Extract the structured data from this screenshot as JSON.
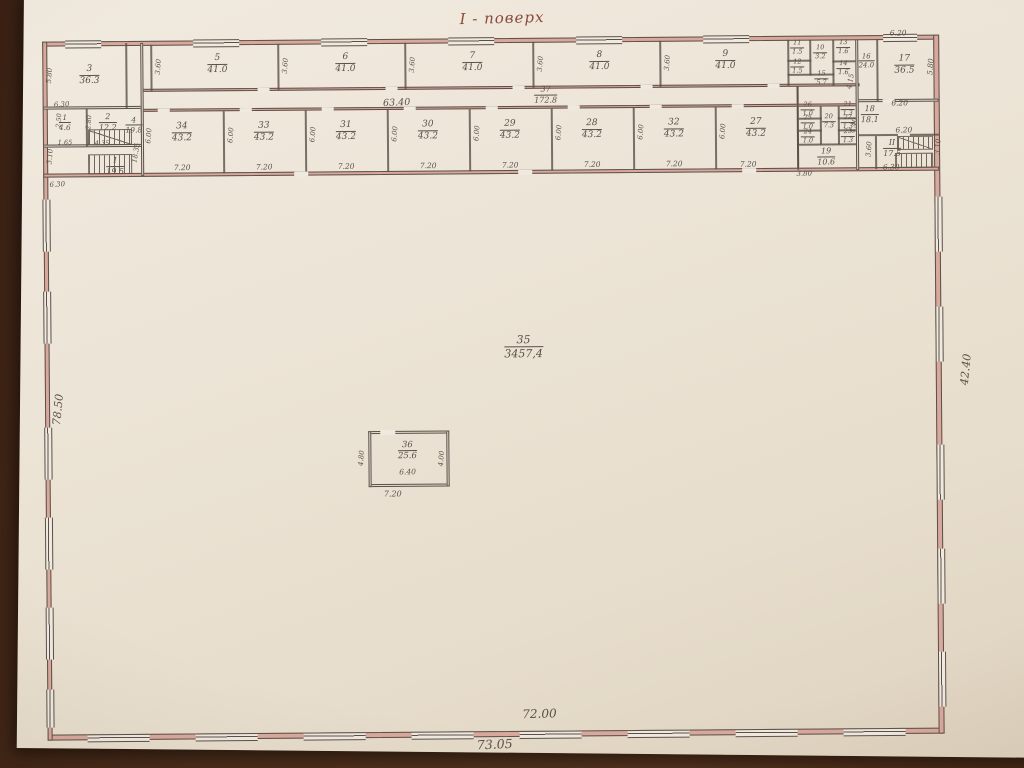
{
  "title": {
    "text": "І - поверх"
  },
  "colors": {
    "ink": "#5a5048",
    "poche": "#d8a89c",
    "paper": "#ebe3d4",
    "desk": "#46291a",
    "title_ink": "#8a4a3a"
  },
  "plan": {
    "rooms": [
      {
        "n": "3",
        "a": "36.3",
        "x": 92,
        "y": 72
      },
      {
        "n": "4",
        "a": "19.8",
        "x": 136,
        "y": 122,
        "s": 7.5
      },
      {
        "n": "5",
        "a": "41.0",
        "x": 220,
        "y": 62
      },
      {
        "n": "6",
        "a": "41.0",
        "x": 348,
        "y": 62
      },
      {
        "n": "7",
        "a": "41.0",
        "x": 475,
        "y": 62
      },
      {
        "n": "8",
        "a": "41.0",
        "x": 602,
        "y": 62
      },
      {
        "n": "9",
        "a": "41.0",
        "x": 728,
        "y": 62
      },
      {
        "n": "10",
        "a": "3.2",
        "x": 823,
        "y": 55,
        "s": 6.5
      },
      {
        "n": "11",
        "a": "1.5",
        "x": 800,
        "y": 50,
        "s": 6.5
      },
      {
        "n": "12",
        "a": "1.5",
        "x": 800,
        "y": 69,
        "s": 6.5
      },
      {
        "n": "13",
        "a": "1.6",
        "x": 846,
        "y": 50,
        "s": 6.5
      },
      {
        "n": "14",
        "a": "1.6",
        "x": 846,
        "y": 71,
        "s": 6.5
      },
      {
        "n": "15",
        "a": "5.7",
        "x": 824,
        "y": 81,
        "s": 6.5
      },
      {
        "n": "16",
        "a": "24.0",
        "x": 869,
        "y": 64,
        "s": 7
      },
      {
        "n": "17",
        "a": "36.5",
        "x": 907,
        "y": 68
      },
      {
        "n": "18",
        "a": "18.1",
        "x": 872,
        "y": 117,
        "s": 8
      },
      {
        "n": "19",
        "a": "10.6",
        "x": 828,
        "y": 159,
        "s": 8
      },
      {
        "n": "20",
        "a": "7.3",
        "x": 831,
        "y": 124,
        "s": 6.5
      },
      {
        "n": "21",
        "a": "1.3",
        "x": 850,
        "y": 112,
        "s": 6.5
      },
      {
        "n": "22",
        "a": "1.3",
        "x": 850,
        "y": 125,
        "s": 6.5
      },
      {
        "n": "23",
        "a": "1.3",
        "x": 850,
        "y": 139,
        "s": 6.5
      },
      {
        "n": "24",
        "a": "1.0",
        "x": 810,
        "y": 139,
        "s": 6.5
      },
      {
        "n": "25",
        "a": "1.0",
        "x": 810,
        "y": 125,
        "s": 6.5
      },
      {
        "n": "26",
        "a": "1.0",
        "x": 810,
        "y": 112,
        "s": 6.5
      },
      {
        "n": "34",
        "a": "43.2",
        "x": 184,
        "y": 130
      },
      {
        "n": "33",
        "a": "43.2",
        "x": 266,
        "y": 130
      },
      {
        "n": "31",
        "a": "43.2",
        "x": 348,
        "y": 130
      },
      {
        "n": "30",
        "a": "43.2",
        "x": 430,
        "y": 130
      },
      {
        "n": "29",
        "a": "43.2",
        "x": 512,
        "y": 130
      },
      {
        "n": "28",
        "a": "43.2",
        "x": 594,
        "y": 130
      },
      {
        "n": "32",
        "a": "43.2",
        "x": 676,
        "y": 130
      },
      {
        "n": "27",
        "a": "43.2",
        "x": 758,
        "y": 130
      },
      {
        "n": "1",
        "a": "4.6",
        "x": 67,
        "y": 119,
        "s": 7.5
      },
      {
        "n": "2",
        "a": "12.2",
        "x": 110,
        "y": 119,
        "s": 8
      },
      {
        "n": "I",
        "a": "19.5",
        "x": 117,
        "y": 163,
        "s": 8
      },
      {
        "n": "II",
        "a": "17.5",
        "x": 894,
        "y": 151,
        "s": 8
      },
      {
        "n": "37",
        "a": "172.8",
        "x": 548,
        "y": 95,
        "s": 8
      },
      {
        "n": "35",
        "a": "3457,4",
        "x": 524,
        "y": 347,
        "s": 11
      },
      {
        "n": "36",
        "a": "25.6",
        "x": 407,
        "y": 450,
        "s": 8.5
      }
    ],
    "dims": [
      {
        "t": "63.40",
        "x": 399,
        "y": 102,
        "r": -2,
        "s": 9.5
      },
      {
        "t": "72.00",
        "x": 537,
        "y": 714,
        "r": -1,
        "s": 12
      },
      {
        "t": "73.05",
        "x": 492,
        "y": 744,
        "r": -2,
        "s": 12.5
      },
      {
        "t": "42.40",
        "x": 966,
        "y": 373,
        "r": -84,
        "s": 11
      },
      {
        "t": "78.50",
        "x": 58,
        "y": 406,
        "r": -84,
        "s": 11
      },
      {
        "t": "5.80",
        "x": 52,
        "y": 72,
        "r": -85,
        "s": 7
      },
      {
        "t": "6.30",
        "x": 64,
        "y": 101,
        "r": -3,
        "s": 7
      },
      {
        "t": "3.10",
        "x": 52,
        "y": 153,
        "r": -85,
        "s": 7
      },
      {
        "t": "6.30",
        "x": 59,
        "y": 181,
        "r": -3,
        "s": 7
      },
      {
        "t": "1.65",
        "x": 67,
        "y": 139,
        "s": 6.5
      },
      {
        "t": "4.35",
        "x": 104,
        "y": 140,
        "s": 6.5
      },
      {
        "t": "2.80",
        "x": 91,
        "y": 119,
        "r": -85,
        "s": 6.5
      },
      {
        "t": "2.50",
        "x": 61,
        "y": 117,
        "r": -85,
        "s": 6.5
      },
      {
        "t": "18.35",
        "x": 138,
        "y": 150,
        "r": -80,
        "s": 7
      },
      {
        "t": "3.60",
        "x": 161,
        "y": 64,
        "r": -85,
        "s": 7
      },
      {
        "t": "3.60",
        "x": 288,
        "y": 64,
        "r": -85,
        "s": 7
      },
      {
        "t": "3.60",
        "x": 415,
        "y": 64,
        "r": -85,
        "s": 7
      },
      {
        "t": "3.60",
        "x": 543,
        "y": 64,
        "r": -85,
        "s": 7
      },
      {
        "t": "3.60",
        "x": 670,
        "y": 64,
        "r": -85,
        "s": 7
      },
      {
        "t": "6.00",
        "x": 151,
        "y": 133,
        "r": -85,
        "s": 7
      },
      {
        "t": "6.00",
        "x": 233,
        "y": 133,
        "r": -85,
        "s": 7
      },
      {
        "t": "6.00",
        "x": 315,
        "y": 133,
        "r": -85,
        "s": 7
      },
      {
        "t": "6.00",
        "x": 397,
        "y": 133,
        "r": -85,
        "s": 7
      },
      {
        "t": "6.00",
        "x": 479,
        "y": 133,
        "r": -85,
        "s": 7
      },
      {
        "t": "6.00",
        "x": 561,
        "y": 133,
        "r": -85,
        "s": 7
      },
      {
        "t": "6.00",
        "x": 643,
        "y": 133,
        "r": -85,
        "s": 7
      },
      {
        "t": "6.00",
        "x": 725,
        "y": 133,
        "r": -85,
        "s": 7
      },
      {
        "t": "7.20",
        "x": 184,
        "y": 165,
        "s": 7.5
      },
      {
        "t": "7.20",
        "x": 266,
        "y": 165,
        "s": 7.5
      },
      {
        "t": "7.20",
        "x": 348,
        "y": 165,
        "s": 7.5
      },
      {
        "t": "7.20",
        "x": 430,
        "y": 165,
        "s": 7.5
      },
      {
        "t": "7.20",
        "x": 512,
        "y": 165,
        "s": 7.5
      },
      {
        "t": "7.20",
        "x": 594,
        "y": 165,
        "s": 7.5
      },
      {
        "t": "7.20",
        "x": 676,
        "y": 165,
        "s": 7.5
      },
      {
        "t": "7.20",
        "x": 750,
        "y": 166,
        "s": 7.5
      },
      {
        "t": "6.20",
        "x": 901,
        "y": 36,
        "s": 7.5
      },
      {
        "t": "5.80",
        "x": 933,
        "y": 70,
        "r": -85,
        "s": 7.5
      },
      {
        "t": "6.20",
        "x": 902,
        "y": 106,
        "s": 7.5
      },
      {
        "t": "6.20",
        "x": 906,
        "y": 133,
        "s": 7.5
      },
      {
        "t": "6.30",
        "x": 893,
        "y": 170,
        "s": 7.5
      },
      {
        "t": "3.60",
        "x": 871,
        "y": 152,
        "r": -85,
        "s": 7
      },
      {
        "t": "3.10",
        "x": 940,
        "y": 150,
        "r": -85,
        "s": 7
      },
      {
        "t": "4.15",
        "x": 853,
        "y": 84,
        "r": -78,
        "s": 7
      },
      {
        "t": "4.40",
        "x": 856,
        "y": 128,
        "r": -80,
        "s": 7
      },
      {
        "t": "3.80",
        "x": 806,
        "y": 176,
        "s": 7
      },
      {
        "t": "6.40",
        "x": 407,
        "y": 471,
        "s": 7.5
      },
      {
        "t": "7.20",
        "x": 392,
        "y": 493,
        "s": 8
      },
      {
        "t": "4.80",
        "x": 361,
        "y": 457,
        "r": -85,
        "s": 7
      },
      {
        "t": "4.00",
        "x": 441,
        "y": 458,
        "r": -85,
        "s": 7
      }
    ],
    "walls": [
      {
        "x": 45,
        "y": 38,
        "w": 896,
        "h": 5,
        "pk": 1
      },
      {
        "x": 45,
        "y": 731,
        "w": 896,
        "h": 6,
        "pk": 1
      },
      {
        "x": 45,
        "y": 38,
        "w": 5,
        "h": 699,
        "pk": 1
      },
      {
        "x": 936,
        "y": 38,
        "w": 6,
        "h": 699,
        "pk": 1
      },
      {
        "x": 45,
        "y": 103,
        "w": 100,
        "h": 3
      },
      {
        "x": 45,
        "y": 141,
        "w": 100,
        "h": 3
      },
      {
        "x": 45,
        "y": 170,
        "w": 896,
        "h": 4,
        "pk": 1
      },
      {
        "x": 143,
        "y": 86,
        "w": 719,
        "h": 3,
        "pk": 1
      },
      {
        "x": 143,
        "y": 106,
        "w": 716,
        "h": 3,
        "pk": 1
      },
      {
        "x": 858,
        "y": 102,
        "w": 83,
        "h": 3
      },
      {
        "x": 858,
        "y": 137,
        "w": 83,
        "h": 2,
        "tn": 1
      },
      {
        "x": 790,
        "y": 62,
        "w": 24,
        "h": 2,
        "tn": 1
      },
      {
        "x": 835,
        "y": 63,
        "w": 25,
        "h": 2,
        "tn": 1
      },
      {
        "x": 790,
        "y": 76,
        "w": 47,
        "h": 2,
        "tn": 1
      },
      {
        "x": 799,
        "y": 120,
        "w": 25,
        "h": 2,
        "tn": 1
      },
      {
        "x": 799,
        "y": 132,
        "w": 25,
        "h": 2,
        "tn": 1
      },
      {
        "x": 840,
        "y": 120,
        "w": 20,
        "h": 2,
        "tn": 1
      },
      {
        "x": 840,
        "y": 132,
        "w": 20,
        "h": 2,
        "tn": 1
      },
      {
        "x": 799,
        "y": 146,
        "w": 61,
        "h": 2,
        "tn": 1
      },
      {
        "x": 128,
        "y": 40,
        "w": 2,
        "h": 65,
        "tn": 1
      },
      {
        "x": 143,
        "y": 40,
        "w": 3,
        "h": 133
      },
      {
        "x": 88,
        "y": 105,
        "w": 2,
        "h": 38,
        "tn": 1
      },
      {
        "x": 153,
        "y": 42,
        "w": 2,
        "h": 46,
        "tn": 1
      },
      {
        "x": 280,
        "y": 42,
        "w": 2,
        "h": 46,
        "tn": 1
      },
      {
        "x": 407,
        "y": 42,
        "w": 2,
        "h": 46,
        "tn": 1
      },
      {
        "x": 535,
        "y": 42,
        "w": 2,
        "h": 46,
        "tn": 1
      },
      {
        "x": 662,
        "y": 42,
        "w": 2,
        "h": 46,
        "tn": 1
      },
      {
        "x": 790,
        "y": 42,
        "w": 2,
        "h": 46,
        "tn": 1
      },
      {
        "x": 812,
        "y": 42,
        "w": 2,
        "h": 36,
        "tn": 1
      },
      {
        "x": 835,
        "y": 42,
        "w": 2,
        "h": 46,
        "tn": 1
      },
      {
        "x": 858,
        "y": 42,
        "w": 3,
        "h": 131
      },
      {
        "x": 879,
        "y": 42,
        "w": 2,
        "h": 62,
        "tn": 1
      },
      {
        "x": 877,
        "y": 139,
        "w": 2,
        "h": 33,
        "tn": 1
      },
      {
        "x": 225,
        "y": 109,
        "w": 2,
        "h": 62,
        "tn": 1
      },
      {
        "x": 307,
        "y": 109,
        "w": 2,
        "h": 62,
        "tn": 1
      },
      {
        "x": 389,
        "y": 109,
        "w": 2,
        "h": 62,
        "tn": 1
      },
      {
        "x": 471,
        "y": 109,
        "w": 2,
        "h": 62,
        "tn": 1
      },
      {
        "x": 553,
        "y": 109,
        "w": 2,
        "h": 62,
        "tn": 1
      },
      {
        "x": 635,
        "y": 109,
        "w": 2,
        "h": 62,
        "tn": 1
      },
      {
        "x": 717,
        "y": 109,
        "w": 2,
        "h": 62,
        "tn": 1
      },
      {
        "x": 799,
        "y": 88,
        "w": 2,
        "h": 84
      },
      {
        "x": 822,
        "y": 109,
        "w": 2,
        "h": 38,
        "tn": 1
      },
      {
        "x": 840,
        "y": 109,
        "w": 2,
        "h": 38,
        "tn": 1
      },
      {
        "x": 368,
        "y": 430,
        "w": 81,
        "h": 3
      },
      {
        "x": 368,
        "y": 483,
        "w": 81,
        "h": 3
      },
      {
        "x": 368,
        "y": 430,
        "w": 3,
        "h": 56
      },
      {
        "x": 446,
        "y": 430,
        "w": 3,
        "h": 56
      }
    ],
    "openings": [
      {
        "x": 380,
        "y": 429,
        "w": 15,
        "h": 5
      },
      {
        "x": 885,
        "y": 102,
        "w": 12,
        "h": 4
      },
      {
        "x": 900,
        "y": 137,
        "w": 12,
        "h": 3
      },
      {
        "x": 160,
        "y": 106,
        "w": 12,
        "h": 4
      },
      {
        "x": 242,
        "y": 106,
        "w": 12,
        "h": 4
      },
      {
        "x": 324,
        "y": 106,
        "w": 12,
        "h": 4
      },
      {
        "x": 406,
        "y": 106,
        "w": 12,
        "h": 4
      },
      {
        "x": 488,
        "y": 106,
        "w": 12,
        "h": 4
      },
      {
        "x": 570,
        "y": 106,
        "w": 12,
        "h": 4
      },
      {
        "x": 652,
        "y": 106,
        "w": 12,
        "h": 4
      },
      {
        "x": 734,
        "y": 106,
        "w": 12,
        "h": 4
      },
      {
        "x": 260,
        "y": 86,
        "w": 12,
        "h": 4
      },
      {
        "x": 388,
        "y": 86,
        "w": 12,
        "h": 4
      },
      {
        "x": 515,
        "y": 86,
        "w": 12,
        "h": 4
      },
      {
        "x": 643,
        "y": 86,
        "w": 12,
        "h": 4
      },
      {
        "x": 770,
        "y": 86,
        "w": 12,
        "h": 4
      },
      {
        "x": 296,
        "y": 170,
        "w": 14,
        "h": 5
      },
      {
        "x": 520,
        "y": 170,
        "w": 14,
        "h": 5
      },
      {
        "x": 744,
        "y": 170,
        "w": 14,
        "h": 5
      }
    ],
    "windows": [
      {
        "o": "h",
        "x": 68,
        "y": 37,
        "w": 36,
        "h": 6
      },
      {
        "o": "h",
        "x": 196,
        "y": 37,
        "w": 46,
        "h": 6
      },
      {
        "o": "h",
        "x": 324,
        "y": 37,
        "w": 46,
        "h": 6
      },
      {
        "o": "h",
        "x": 451,
        "y": 37,
        "w": 46,
        "h": 6
      },
      {
        "o": "h",
        "x": 579,
        "y": 37,
        "w": 46,
        "h": 6
      },
      {
        "o": "h",
        "x": 706,
        "y": 37,
        "w": 46,
        "h": 6
      },
      {
        "o": "h",
        "x": 886,
        "y": 37,
        "w": 34,
        "h": 6
      },
      {
        "o": "h",
        "x": 85,
        "y": 731,
        "w": 62,
        "h": 6
      },
      {
        "o": "h",
        "x": 193,
        "y": 731,
        "w": 62,
        "h": 6
      },
      {
        "o": "h",
        "x": 301,
        "y": 731,
        "w": 62,
        "h": 6
      },
      {
        "o": "h",
        "x": 409,
        "y": 731,
        "w": 62,
        "h": 6
      },
      {
        "o": "h",
        "x": 517,
        "y": 731,
        "w": 62,
        "h": 6
      },
      {
        "o": "h",
        "x": 625,
        "y": 731,
        "w": 62,
        "h": 6
      },
      {
        "o": "h",
        "x": 733,
        "y": 731,
        "w": 62,
        "h": 6
      },
      {
        "o": "h",
        "x": 841,
        "y": 731,
        "w": 62,
        "h": 6
      },
      {
        "o": "v",
        "x": 44,
        "y": 196,
        "w": 6,
        "h": 52
      },
      {
        "o": "v",
        "x": 44,
        "y": 288,
        "w": 6,
        "h": 52
      },
      {
        "o": "v",
        "x": 44,
        "y": 424,
        "w": 6,
        "h": 52
      },
      {
        "o": "v",
        "x": 44,
        "y": 514,
        "w": 6,
        "h": 52
      },
      {
        "o": "v",
        "x": 44,
        "y": 604,
        "w": 6,
        "h": 52
      },
      {
        "o": "v",
        "x": 44,
        "y": 686,
        "w": 6,
        "h": 38
      },
      {
        "o": "v",
        "x": 936,
        "y": 200,
        "w": 6,
        "h": 55
      },
      {
        "o": "v",
        "x": 936,
        "y": 310,
        "w": 6,
        "h": 55
      },
      {
        "o": "v",
        "x": 936,
        "y": 448,
        "w": 6,
        "h": 55
      },
      {
        "o": "v",
        "x": 936,
        "y": 552,
        "w": 6,
        "h": 55
      },
      {
        "o": "v",
        "x": 936,
        "y": 655,
        "w": 6,
        "h": 55
      }
    ],
    "stairs": [
      {
        "x": 90,
        "y": 126,
        "w": 44,
        "h": 16,
        "d": 1
      },
      {
        "x": 90,
        "y": 151,
        "w": 44,
        "h": 20
      },
      {
        "x": 899,
        "y": 139,
        "w": 36,
        "h": 14,
        "d": 1
      },
      {
        "x": 897,
        "y": 156,
        "w": 38,
        "h": 15
      }
    ]
  }
}
